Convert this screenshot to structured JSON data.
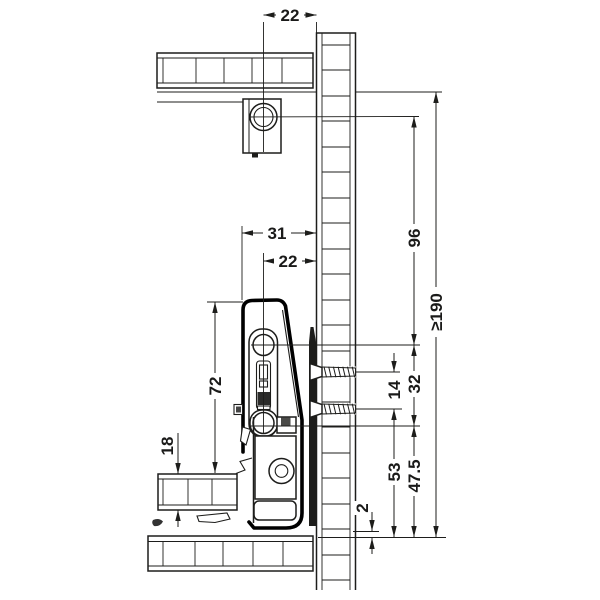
{
  "drawing": {
    "kind": "drawer slide installation cross-section",
    "background": "#ffffff",
    "line_color": "#1d1d1b",
    "accent_fill": "#1d1d1b"
  },
  "dims": {
    "d22_top": "22",
    "d31": "31",
    "d22_mid": "22",
    "d96": "96",
    "d190": "≥190",
    "d32": "32",
    "d14": "14",
    "d53": "53",
    "d47_5": "47.5",
    "d72": "72",
    "d18": "18",
    "d2": "2"
  }
}
